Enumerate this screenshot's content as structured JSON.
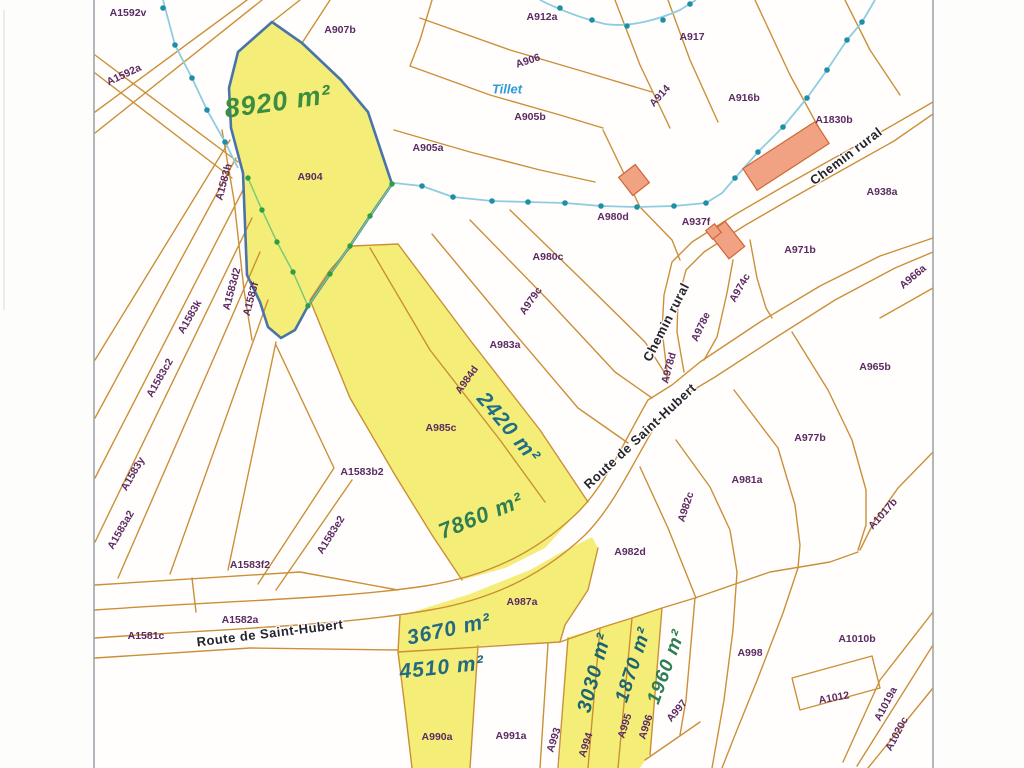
{
  "map": {
    "colors": {
      "parcel_line": "#c98a2f",
      "highlight_yellow": "#f4ee79",
      "highlight_outline_blue": "#4a74a8",
      "stream_line": "#8fcce0",
      "stream_dot": "#1f8fa8",
      "green_boundary_line": "#7cc87c",
      "green_boundary_dot": "#2f9e42",
      "building_fill": "#f0a283",
      "building_line": "#cf6636",
      "parcel_label": "#5b2a62",
      "road_label": "#26242c",
      "water_label": "#2e9bd6",
      "frame": "#9aa0a6",
      "paper": "#fdfdfb"
    },
    "parcel_labels": [
      {
        "text": "A1592v",
        "x": 128,
        "y": 13,
        "rot": 0
      },
      {
        "text": "A1592a",
        "x": 124,
        "y": 75,
        "rot": -25
      },
      {
        "text": "A907b",
        "x": 340,
        "y": 30,
        "rot": 0
      },
      {
        "text": "A912a",
        "x": 542,
        "y": 17,
        "rot": 0
      },
      {
        "text": "A917",
        "x": 692,
        "y": 37,
        "rot": 0
      },
      {
        "text": "A906",
        "x": 528,
        "y": 61,
        "rot": -18
      },
      {
        "text": "A914",
        "x": 660,
        "y": 96,
        "rot": -48
      },
      {
        "text": "A916b",
        "x": 744,
        "y": 98,
        "rot": 0
      },
      {
        "text": "A905b",
        "x": 530,
        "y": 117,
        "rot": 0
      },
      {
        "text": "A1830b",
        "x": 834,
        "y": 120,
        "rot": 0
      },
      {
        "text": "A905a",
        "x": 428,
        "y": 148,
        "rot": 0
      },
      {
        "text": "A938a",
        "x": 882,
        "y": 192,
        "rot": 0
      },
      {
        "text": "A904",
        "x": 310,
        "y": 177,
        "rot": 0
      },
      {
        "text": "A980d",
        "x": 613,
        "y": 217,
        "rot": 0
      },
      {
        "text": "A937f",
        "x": 696,
        "y": 222,
        "rot": 0
      },
      {
        "text": "A971b",
        "x": 800,
        "y": 250,
        "rot": 0
      },
      {
        "text": "A980c",
        "x": 548,
        "y": 257,
        "rot": 0
      },
      {
        "text": "A974c",
        "x": 740,
        "y": 288,
        "rot": -60
      },
      {
        "text": "A966a",
        "x": 913,
        "y": 277,
        "rot": -40
      },
      {
        "text": "A979c",
        "x": 531,
        "y": 301,
        "rot": -55
      },
      {
        "text": "A978e",
        "x": 701,
        "y": 327,
        "rot": -65
      },
      {
        "text": "A983a",
        "x": 505,
        "y": 345,
        "rot": 0
      },
      {
        "text": "A978d",
        "x": 669,
        "y": 368,
        "rot": -75
      },
      {
        "text": "A965b",
        "x": 875,
        "y": 367,
        "rot": 0
      },
      {
        "text": "A984d",
        "x": 467,
        "y": 380,
        "rot": -55
      },
      {
        "text": "A1583h",
        "x": 224,
        "y": 182,
        "rot": -75
      },
      {
        "text": "A1583d2",
        "x": 232,
        "y": 289,
        "rot": -75
      },
      {
        "text": "A1583f",
        "x": 251,
        "y": 299,
        "rot": -75
      },
      {
        "text": "A1583k",
        "x": 190,
        "y": 317,
        "rot": -60
      },
      {
        "text": "A1583c2",
        "x": 160,
        "y": 378,
        "rot": -60
      },
      {
        "text": "A985c",
        "x": 441,
        "y": 428,
        "rot": 0
      },
      {
        "text": "A977b",
        "x": 810,
        "y": 438,
        "rot": 0
      },
      {
        "text": "A1583b2",
        "x": 362,
        "y": 472,
        "rot": 0
      },
      {
        "text": "A1583y",
        "x": 133,
        "y": 474,
        "rot": -60
      },
      {
        "text": "A981a",
        "x": 747,
        "y": 480,
        "rot": 0
      },
      {
        "text": "A982c",
        "x": 686,
        "y": 507,
        "rot": -72
      },
      {
        "text": "A1583a2",
        "x": 121,
        "y": 530,
        "rot": -60
      },
      {
        "text": "A1583e2",
        "x": 331,
        "y": 535,
        "rot": -58
      },
      {
        "text": "A1017b",
        "x": 883,
        "y": 514,
        "rot": -48
      },
      {
        "text": "A1583f2",
        "x": 250,
        "y": 565,
        "rot": 0
      },
      {
        "text": "A982d",
        "x": 630,
        "y": 552,
        "rot": 0
      },
      {
        "text": "A987a",
        "x": 522,
        "y": 602,
        "rot": 0
      },
      {
        "text": "A1582a",
        "x": 240,
        "y": 620,
        "rot": 0
      },
      {
        "text": "A1581c",
        "x": 146,
        "y": 636,
        "rot": 0
      },
      {
        "text": "A998",
        "x": 750,
        "y": 653,
        "rot": 0
      },
      {
        "text": "A1010b",
        "x": 857,
        "y": 639,
        "rot": 0
      },
      {
        "text": "A990a",
        "x": 437,
        "y": 737,
        "rot": 0
      },
      {
        "text": "A991a",
        "x": 511,
        "y": 736,
        "rot": 0
      },
      {
        "text": "A993",
        "x": 554,
        "y": 740,
        "rot": -72
      },
      {
        "text": "A994",
        "x": 586,
        "y": 745,
        "rot": -72
      },
      {
        "text": "A995",
        "x": 625,
        "y": 726,
        "rot": -72
      },
      {
        "text": "A996",
        "x": 646,
        "y": 727,
        "rot": -72
      },
      {
        "text": "A997",
        "x": 677,
        "y": 711,
        "rot": -50
      },
      {
        "text": "A1012",
        "x": 834,
        "y": 698,
        "rot": -10
      },
      {
        "text": "A1019a",
        "x": 886,
        "y": 704,
        "rot": -62
      },
      {
        "text": "A1020c",
        "x": 897,
        "y": 734,
        "rot": -62
      }
    ],
    "road_labels": [
      {
        "text": "Route de Saint-Hubert",
        "x": 270,
        "y": 633,
        "rot": -7
      },
      {
        "text": "Route de Saint-Hubert",
        "x": 640,
        "y": 436,
        "rot": -43
      },
      {
        "text": "Chemin rural",
        "x": 666,
        "y": 322,
        "rot": -63
      },
      {
        "text": "Chemin rural",
        "x": 846,
        "y": 156,
        "rot": -37
      }
    ],
    "water_labels": [
      {
        "text": "Tillet",
        "x": 507,
        "y": 89,
        "rot": 0
      }
    ],
    "area_labels": [
      {
        "text": "8920 m²",
        "x": 278,
        "y": 102,
        "rot": -8,
        "color": "#3b8d3f",
        "size": 27
      },
      {
        "text": "2420 m²",
        "x": 508,
        "y": 428,
        "rot": 50,
        "color": "#1f6e86",
        "size": 21
      },
      {
        "text": "7860 m²",
        "x": 481,
        "y": 516,
        "rot": -22,
        "color": "#2f7d52",
        "size": 22
      },
      {
        "text": "3670 m²",
        "x": 449,
        "y": 630,
        "rot": -12,
        "color": "#226a80",
        "size": 21
      },
      {
        "text": "4510 m²",
        "x": 442,
        "y": 668,
        "rot": -6,
        "color": "#226a80",
        "size": 21
      },
      {
        "text": "3030 m²",
        "x": 595,
        "y": 673,
        "rot": -75,
        "color": "#1d6472",
        "size": 20
      },
      {
        "text": "1870 m²",
        "x": 634,
        "y": 665,
        "rot": -72,
        "color": "#1d6472",
        "size": 19
      },
      {
        "text": "1960 m²",
        "x": 667,
        "y": 667,
        "rot": -70,
        "color": "#2f7d52",
        "size": 19
      }
    ]
  }
}
